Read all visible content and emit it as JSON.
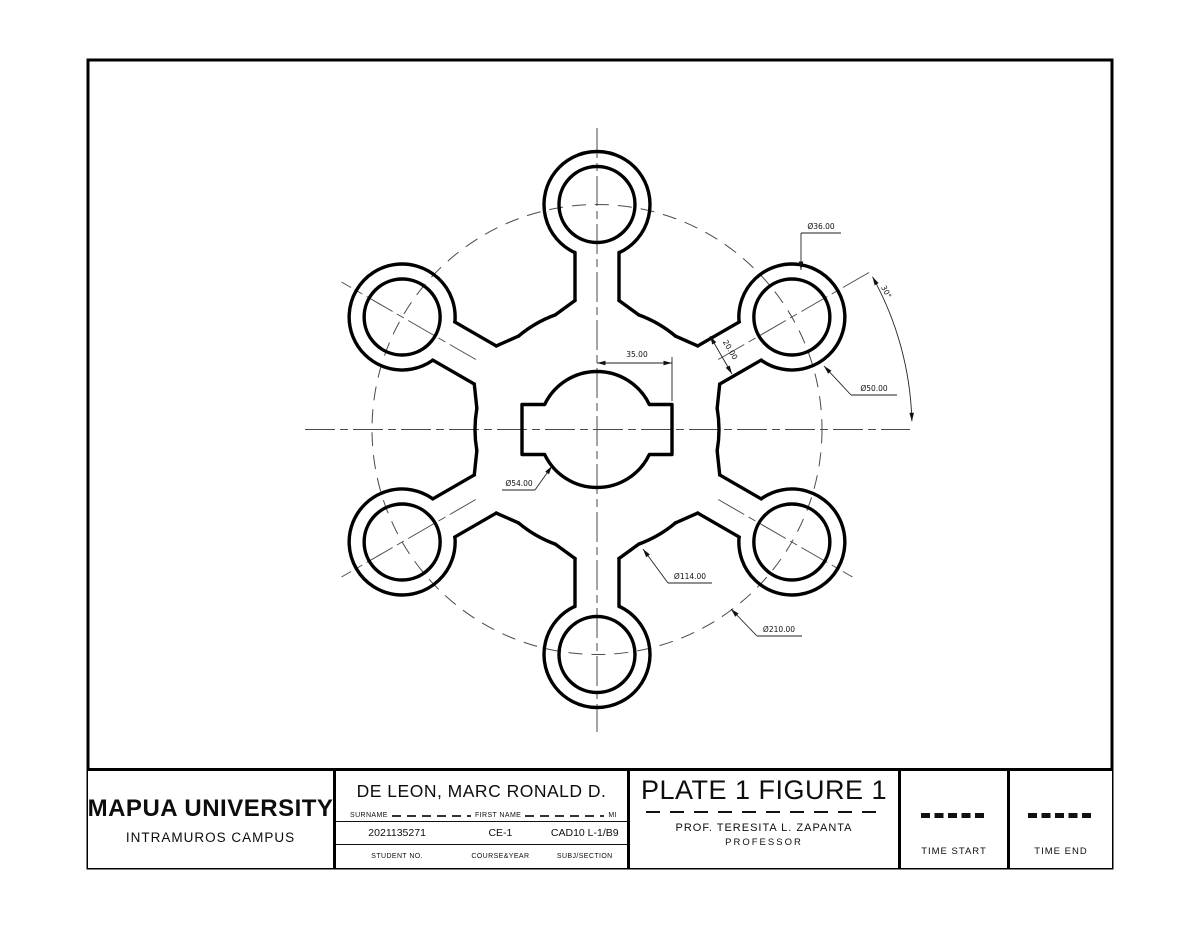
{
  "title_block": {
    "university": "MAPUA UNIVERSITY",
    "campus": "INTRAMUROS CAMPUS",
    "student_name": "DE LEON, MARC RONALD D.",
    "surname_label": "SURNAME",
    "first_name_label": "FIRST NAME",
    "mi_label": "MI",
    "student_no": "2021135271",
    "course_year": "CE-1",
    "subj_section": "CAD10 L-1/B9",
    "student_no_label": "STUDENT NO.",
    "course_year_label": "COURSE&YEAR",
    "subj_section_label": "SUBJ/SECTION",
    "plate_title": "PLATE 1 FIGURE 1",
    "professor_name": "PROF. TERESITA L. ZAPANTA",
    "professor_title": "PROFESSOR",
    "time_start_value": "------",
    "time_start_label": "TIME START",
    "time_end_value": "------",
    "time_end_label": "TIME END"
  },
  "drawing": {
    "border": {
      "x": 88,
      "y": 60,
      "w": 1024,
      "h": 808,
      "stroke_w": 3
    },
    "center": {
      "x": 597,
      "y": 429.5
    },
    "spoke_angles_deg": [
      90,
      30,
      -30,
      -90,
      -150,
      150
    ],
    "bolt_circle_r": 225,
    "boss": {
      "outer_r": 53,
      "inner_r": 38,
      "gap_half_angle_deg": 25
    },
    "neck": {
      "offset": 22,
      "start_r": 177,
      "end_r": 129
    },
    "scallop": {
      "r": 122,
      "flare_angle_deg": 20
    },
    "hub": {
      "r": 58,
      "tab_half_h": 25,
      "tab_out": 75
    },
    "centerlines": {
      "horizontal": [
        305,
        429.5,
        910,
        429.5
      ],
      "vertical": [
        597,
        128,
        597,
        732
      ],
      "radial": [
        {
          "angle": 30,
          "r1": 140,
          "r2": 318
        },
        {
          "angle": -30,
          "r1": 140,
          "r2": 295
        },
        {
          "angle": 150,
          "r1": 140,
          "r2": 295
        },
        {
          "angle": -150,
          "r1": 140,
          "r2": 295
        }
      ]
    },
    "annotations": [
      {
        "kind": "linear",
        "text": "35.00",
        "x1": 597,
        "y1": 363,
        "x2": 672,
        "y2": 363,
        "tx": 637,
        "ty": 357,
        "rot": 0,
        "ext": [
          [
            672,
            357,
            672,
            401
          ]
        ]
      },
      {
        "kind": "linear",
        "text": "20.00",
        "x1": 710,
        "y1": 336,
        "x2": 732,
        "y2": 374,
        "tx": 728,
        "ty": 351,
        "rot": 60,
        "ext": []
      },
      {
        "kind": "leader",
        "text": "Ø36.00",
        "pts": [
          [
            801,
            270
          ],
          [
            801,
            233
          ],
          [
            841,
            233
          ]
        ],
        "tx": 821,
        "ty": 229
      },
      {
        "kind": "leader",
        "text": "Ø50.00",
        "pts": [
          [
            824,
            366
          ],
          [
            851,
            395
          ],
          [
            897,
            395
          ]
        ],
        "tx": 874,
        "ty": 391
      },
      {
        "kind": "leader",
        "text": "Ø54.00",
        "pts": [
          [
            552,
            466
          ],
          [
            535,
            490
          ],
          [
            502,
            490
          ]
        ],
        "tx": 519,
        "ty": 486
      },
      {
        "kind": "leader",
        "text": "Ø114.00",
        "pts": [
          [
            643,
            549
          ],
          [
            668,
            583
          ],
          [
            712,
            583
          ]
        ],
        "tx": 690,
        "ty": 579
      },
      {
        "kind": "leader",
        "text": "Ø210.00",
        "pts": [
          [
            731,
            609
          ],
          [
            757,
            636
          ],
          [
            802,
            636
          ]
        ],
        "tx": 779,
        "ty": 632
      },
      {
        "kind": "arc",
        "text": "30°",
        "r": 315,
        "a1": 29,
        "a2": 1.5,
        "tx": 884,
        "ty": 293,
        "rot": 62
      }
    ]
  }
}
